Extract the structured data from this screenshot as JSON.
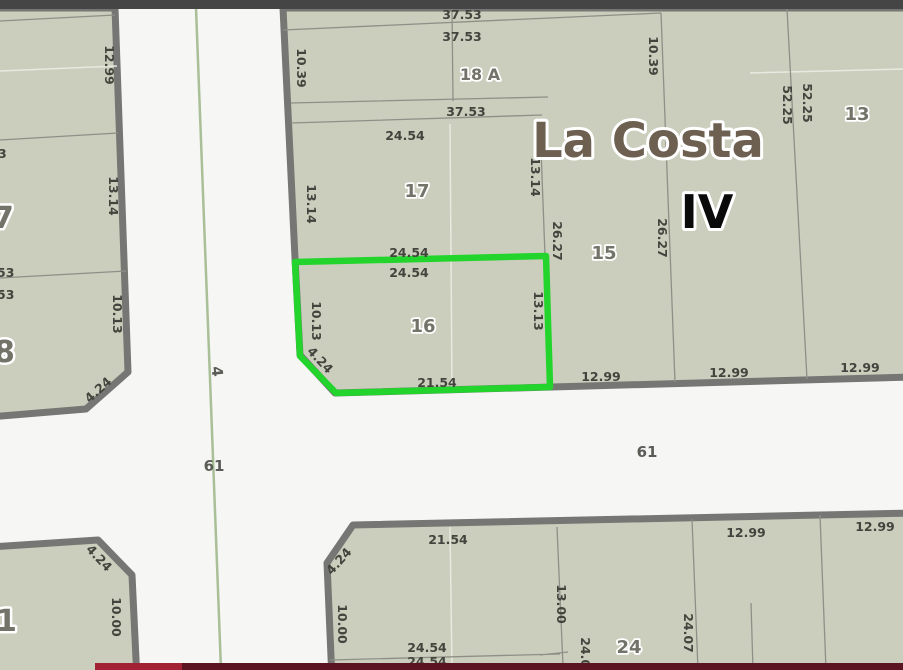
{
  "title": {
    "region": "La Costa",
    "section": "IV"
  },
  "streets": {
    "vertical_number": "4",
    "horizontal_number_left": "61",
    "horizontal_number_right": "61"
  },
  "parcels": {
    "p18a": "18 A",
    "p17": "17",
    "p16": "16",
    "p15": "15",
    "p13": "13",
    "p24": "24",
    "p7_cut": "7",
    "p8_cut": "8",
    "p1_cut": "1"
  },
  "selected_parcel": {
    "id": "16",
    "outline_color": "#22d42c"
  },
  "measurements": [
    "37.53",
    "37.53",
    "10.39",
    "37.53",
    "24.54",
    "13.14",
    "13.14",
    "10.39",
    "52.25",
    "52.25",
    "26.27",
    "26.27",
    "24.54",
    "24.54",
    "10.13",
    "4.24",
    "13.13",
    "21.54",
    "12.99",
    "12.99",
    "12.99",
    "12.99",
    "13.14",
    "10.13",
    "4.24",
    "3",
    "53",
    "53",
    "4.24",
    "10.00",
    "21.54",
    "4.24",
    "10.00",
    "13.00",
    "12.99",
    "12.99",
    "24.54",
    "24.07",
    "24.07",
    "24.54"
  ],
  "colors": {
    "parcel_fill": "#cbcebc",
    "street": "#f6f6f4",
    "border_thick": "#767674",
    "line": "#8f8f88",
    "light_line": "#e9e9e1",
    "selected_green": "#22d42c",
    "title_brown": "#6e6051",
    "label": "#44443e",
    "parcel_label": "#73736a",
    "topbar": "#454545",
    "bottombar_bright": "#a32134",
    "bottombar_dark": "#5c1322",
    "median_green": "#a9bf97"
  }
}
